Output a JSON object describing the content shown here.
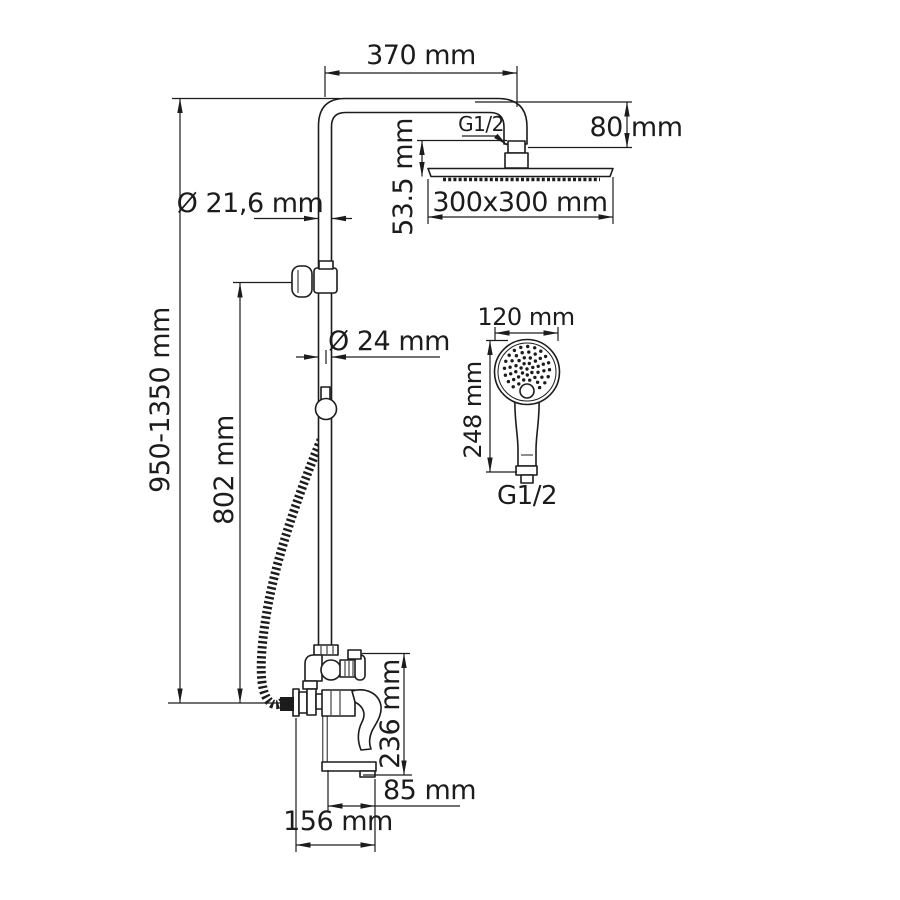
{
  "title": "Shower system dimensional drawing",
  "labels": {
    "overall_height": "950-1350 mm",
    "arm_reach": "370 mm",
    "arm_drop": "80 mm",
    "head_connection": "G1/2",
    "head_height": "53.5 mm",
    "head_size": "300x300 mm",
    "riser_diameter": "Ø 21,6 mm",
    "column_diameter": "Ø 24 mm",
    "bracket_height": "802 mm",
    "handshower_diameter": "120 mm",
    "handshower_length": "248 mm",
    "handshower_connection": "G1/2",
    "mixer_height": "236 mm",
    "spout_reach": "85 mm",
    "mixer_reach": "156 mm"
  }
}
